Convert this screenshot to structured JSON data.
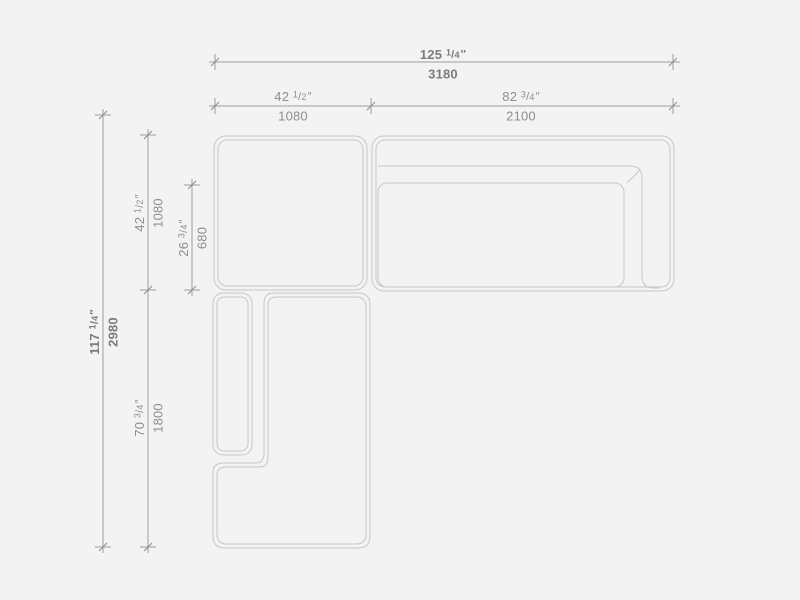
{
  "background_color": "#f3f3f3",
  "colors": {
    "furniture_outline": "#c7c7c7",
    "dimension_line": "#9e9e9e",
    "dimension_tick": "#8a8a8a",
    "dimension_text": "#8e8e8e",
    "dimension_text_emphasis": "#7c7c7c"
  },
  "dimensions": {
    "overall_width": {
      "whole": "125",
      "num": "1",
      "den": "4",
      "unit": "″",
      "mm": "3180"
    },
    "left_module_width": {
      "whole": "42",
      "num": "1",
      "den": "2",
      "unit": "″",
      "mm": "1080"
    },
    "right_module_width": {
      "whole": "82",
      "num": "3",
      "den": "4",
      "unit": "″",
      "mm": "2100"
    },
    "overall_depth": {
      "whole": "117",
      "num": "1",
      "den": "4",
      "unit": "″",
      "mm": "2980"
    },
    "top_module_depth": {
      "whole": "42",
      "num": "1",
      "den": "2",
      "unit": "″",
      "mm": "1080"
    },
    "seat_depth": {
      "whole": "26",
      "num": "3",
      "den": "4",
      "unit": "″",
      "mm": "680"
    },
    "chaise_module_length": {
      "whole": "70",
      "num": "3",
      "den": "4",
      "unit": "″",
      "mm": "1800"
    }
  }
}
